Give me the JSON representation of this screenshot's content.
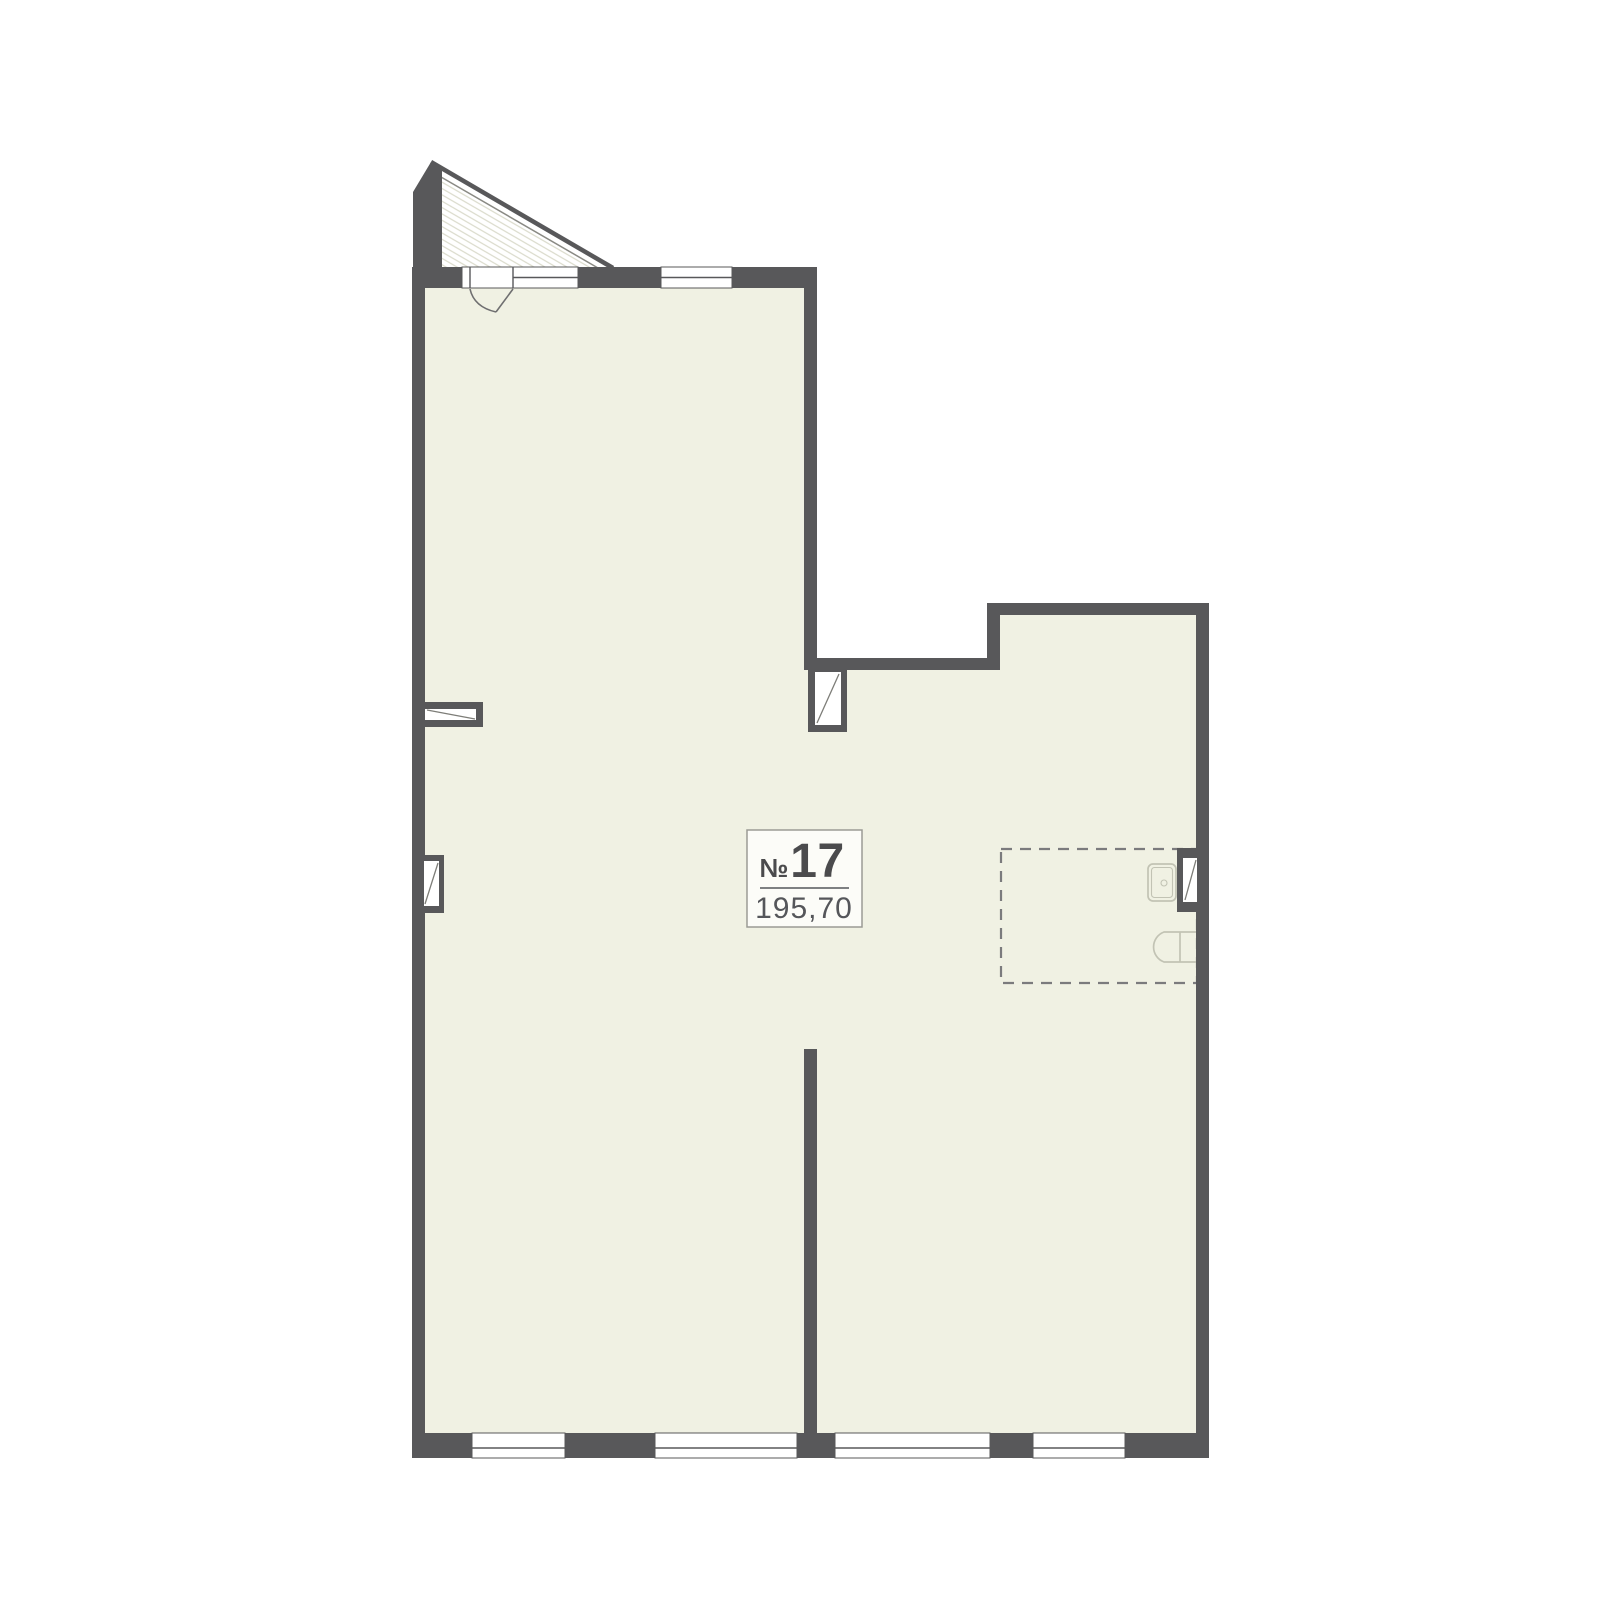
{
  "plan": {
    "unit_label": {
      "prefix": "№",
      "number": "17",
      "area": "195,70"
    },
    "colors": {
      "bg": "#ffffff",
      "wall": "#58585a",
      "floor": "#f0f1e3",
      "hatch": "#d6d7c6",
      "window": "#ffffff",
      "fixture": "#c2c3b4",
      "dashed": "#7b7b7d",
      "ink": "#4b4b4d",
      "muted": "#55565a",
      "label_bg": "#fcfcf8",
      "label_border": "#9b9b95"
    }
  }
}
